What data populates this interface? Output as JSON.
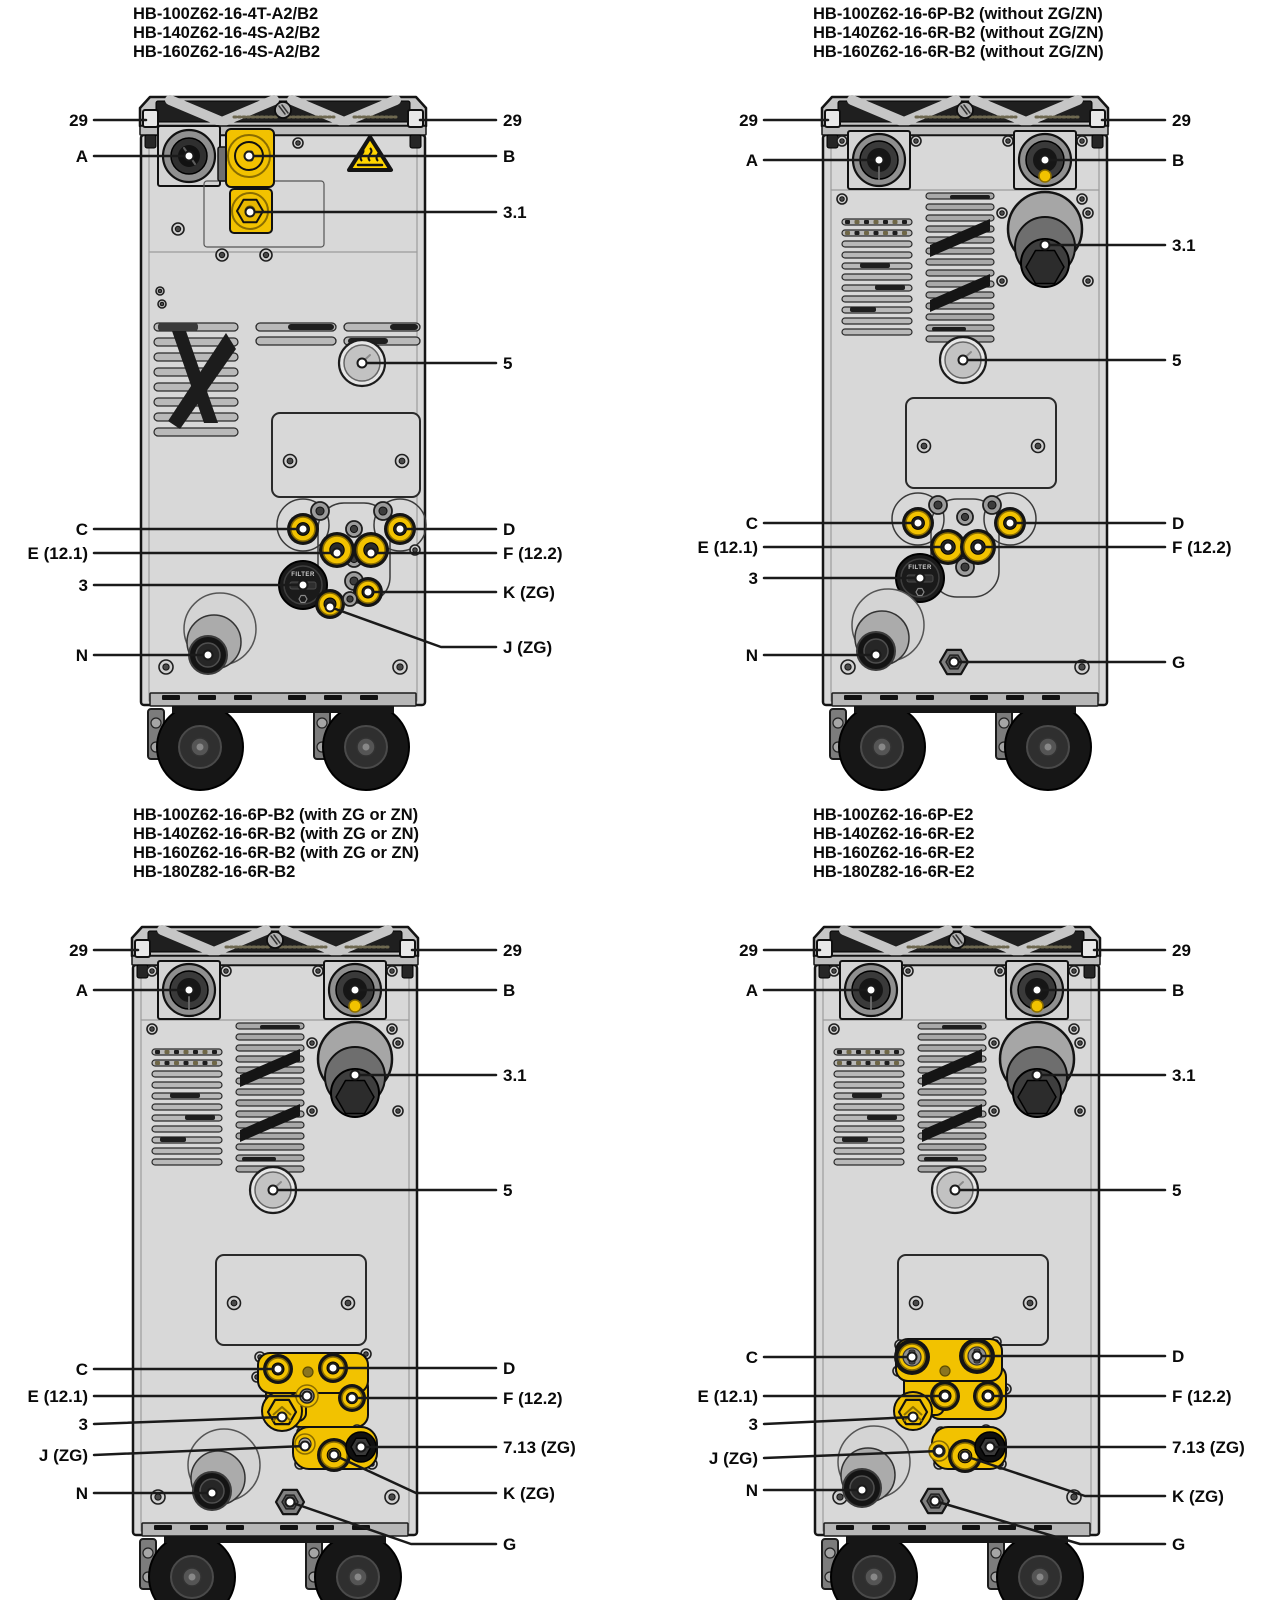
{
  "figure": {
    "background": "#ffffff",
    "width": 1280,
    "height": 1600
  },
  "colors": {
    "accent_yellow": "#f2c200",
    "warning_yellow": "#ffd500",
    "machine_gray": "#d8d8d8",
    "line_black": "#1a1a1a"
  },
  "panels": [
    {
      "id": "panel-top-left",
      "variant": "v1",
      "machine_pos": {
        "x": 138,
        "y": 95
      },
      "title_pos": {
        "x": 133,
        "y": 5
      },
      "title_lines": [
        "HB-100Z62-16-4T-A2/B2",
        "HB-140Z62-16-4S-A2/B2",
        "HB-160Z62-16-4S-A2/B2"
      ],
      "filter_label": "FILTER",
      "label_columns": {
        "left_x": 88,
        "right_x": 503
      },
      "callouts": [
        {
          "label": "29",
          "side": "left",
          "anchor": "tab29l",
          "dot": false
        },
        {
          "label": "29",
          "side": "right",
          "anchor": "tab29r",
          "dot": false
        },
        {
          "label": "A",
          "side": "left",
          "anchor": "a",
          "dot": true
        },
        {
          "label": "B",
          "side": "right",
          "anchor": "b",
          "dot": true
        },
        {
          "label": "3.1",
          "side": "right",
          "anchor": "p31",
          "dot": true
        },
        {
          "label": "5",
          "side": "right",
          "anchor": "gauge",
          "dot": true
        },
        {
          "label": "C",
          "side": "left",
          "anchor": "c",
          "dot": true
        },
        {
          "label": "D",
          "side": "right",
          "anchor": "d",
          "dot": true
        },
        {
          "label": "E (12.1)",
          "side": "left",
          "anchor": "e",
          "dot": true
        },
        {
          "label": "F (12.2)",
          "side": "right",
          "anchor": "f",
          "dot": true
        },
        {
          "label": "3",
          "side": "left",
          "anchor": "filter",
          "dot": true
        },
        {
          "label": "K (ZG)",
          "side": "right",
          "anchor": "k",
          "dot": true
        },
        {
          "label": "J (ZG)",
          "side": "right",
          "anchor": "j",
          "dot": true,
          "label_y": 647,
          "bend_run": 55
        },
        {
          "label": "N",
          "side": "left",
          "anchor": "n",
          "dot": true
        }
      ]
    },
    {
      "id": "panel-top-right",
      "variant": "v2",
      "machine_pos": {
        "x": 820,
        "y": 95
      },
      "title_pos": {
        "x": 813,
        "y": 5
      },
      "title_lines": [
        "HB-100Z62-16-6P-B2 (without ZG/ZN)",
        "HB-140Z62-16-6R-B2 (without ZG/ZN)",
        "HB-160Z62-16-6R-B2 (without ZG/ZN)"
      ],
      "filter_label": "FILTER",
      "label_columns": {
        "left_x": 758,
        "right_x": 1172
      },
      "callouts": [
        {
          "label": "29",
          "side": "left",
          "anchor": "tab29l",
          "dot": false
        },
        {
          "label": "29",
          "side": "right",
          "anchor": "tab29r",
          "dot": false
        },
        {
          "label": "A",
          "side": "left",
          "anchor": "a",
          "dot": true
        },
        {
          "label": "B",
          "side": "right",
          "anchor": "b",
          "dot": true
        },
        {
          "label": "3.1",
          "side": "right",
          "anchor": "p31",
          "dot": true
        },
        {
          "label": "5",
          "side": "right",
          "anchor": "gauge",
          "dot": true
        },
        {
          "label": "C",
          "side": "left",
          "anchor": "c",
          "dot": true
        },
        {
          "label": "D",
          "side": "right",
          "anchor": "d",
          "dot": true
        },
        {
          "label": "E (12.1)",
          "side": "left",
          "anchor": "e",
          "dot": true
        },
        {
          "label": "F (12.2)",
          "side": "right",
          "anchor": "f",
          "dot": true
        },
        {
          "label": "3",
          "side": "left",
          "anchor": "filter",
          "dot": true
        },
        {
          "label": "N",
          "side": "left",
          "anchor": "n",
          "dot": true
        },
        {
          "label": "G",
          "side": "right",
          "anchor": "g",
          "dot": true
        }
      ]
    },
    {
      "id": "panel-bottom-left",
      "variant": "v3",
      "machine_pos": {
        "x": 130,
        "y": 925
      },
      "title_pos": {
        "x": 133,
        "y": 806
      },
      "title_lines": [
        "HB-100Z62-16-6P-B2 (with ZG or ZN)",
        "HB-140Z62-16-6R-B2 (with ZG or ZN)",
        "HB-160Z62-16-6R-B2 (with ZG or ZN)",
        "HB-180Z82-16-6R-B2"
      ],
      "label_columns": {
        "left_x": 88,
        "right_x": 503
      },
      "callouts": [
        {
          "label": "29",
          "side": "left",
          "anchor": "tab29l",
          "dot": false
        },
        {
          "label": "29",
          "side": "right",
          "anchor": "tab29r",
          "dot": false
        },
        {
          "label": "A",
          "side": "left",
          "anchor": "a",
          "dot": true
        },
        {
          "label": "B",
          "side": "right",
          "anchor": "b",
          "dot": true
        },
        {
          "label": "3.1",
          "side": "right",
          "anchor": "p31",
          "dot": true
        },
        {
          "label": "5",
          "side": "right",
          "anchor": "gauge",
          "dot": true
        },
        {
          "label": "C",
          "side": "left",
          "anchor": "c",
          "dot": true
        },
        {
          "label": "D",
          "side": "right",
          "anchor": "d",
          "dot": true
        },
        {
          "label": "E (12.1)",
          "side": "left",
          "anchor": "e",
          "dot": true
        },
        {
          "label": "F (12.2)",
          "side": "right",
          "anchor": "f",
          "dot": true
        },
        {
          "label": "3",
          "side": "left",
          "anchor": "hex3",
          "dot": true,
          "label_y": 1424
        },
        {
          "label": "7.13 (ZG)",
          "side": "right",
          "anchor": "p713",
          "dot": true
        },
        {
          "label": "J (ZG)",
          "side": "left",
          "anchor": "j",
          "dot": true,
          "label_y": 1455
        },
        {
          "label": "N",
          "side": "left",
          "anchor": "n",
          "dot": true
        },
        {
          "label": "K (ZG)",
          "side": "right",
          "anchor": "k",
          "dot": true,
          "label_y": 1493,
          "bend_run": 80
        },
        {
          "label": "G",
          "side": "right",
          "anchor": "g",
          "dot": true,
          "label_y": 1544,
          "bend_run": 85
        }
      ]
    },
    {
      "id": "panel-bottom-right",
      "variant": "v4",
      "machine_pos": {
        "x": 812,
        "y": 925
      },
      "title_pos": {
        "x": 813,
        "y": 806
      },
      "title_lines": [
        "HB-100Z62-16-6P-E2",
        "HB-140Z62-16-6R-E2",
        "HB-160Z62-16-6R-E2",
        "HB-180Z82-16-6R-E2"
      ],
      "label_columns": {
        "left_x": 758,
        "right_x": 1172
      },
      "callouts": [
        {
          "label": "29",
          "side": "left",
          "anchor": "tab29l",
          "dot": false
        },
        {
          "label": "29",
          "side": "right",
          "anchor": "tab29r",
          "dot": false
        },
        {
          "label": "A",
          "side": "left",
          "anchor": "a",
          "dot": true
        },
        {
          "label": "B",
          "side": "right",
          "anchor": "b",
          "dot": true
        },
        {
          "label": "3.1",
          "side": "right",
          "anchor": "p31",
          "dot": true
        },
        {
          "label": "5",
          "side": "right",
          "anchor": "gauge",
          "dot": true
        },
        {
          "label": "C",
          "side": "left",
          "anchor": "c",
          "dot": true
        },
        {
          "label": "D",
          "side": "right",
          "anchor": "d",
          "dot": true
        },
        {
          "label": "E (12.1)",
          "side": "left",
          "anchor": "e",
          "dot": true
        },
        {
          "label": "F (12.2)",
          "side": "right",
          "anchor": "f",
          "dot": true
        },
        {
          "label": "3",
          "side": "left",
          "anchor": "hex3",
          "dot": true,
          "label_y": 1424
        },
        {
          "label": "7.13 (ZG)",
          "side": "right",
          "anchor": "p713",
          "dot": true
        },
        {
          "label": "J (ZG)",
          "side": "left",
          "anchor": "j",
          "dot": true,
          "label_y": 1458
        },
        {
          "label": "N",
          "side": "left",
          "anchor": "n",
          "dot": true
        },
        {
          "label": "K (ZG)",
          "side": "right",
          "anchor": "k",
          "dot": true,
          "label_y": 1496,
          "bend_run": 80
        },
        {
          "label": "G",
          "side": "right",
          "anchor": "g",
          "dot": true,
          "label_y": 1544,
          "bend_run": 85
        }
      ]
    }
  ]
}
